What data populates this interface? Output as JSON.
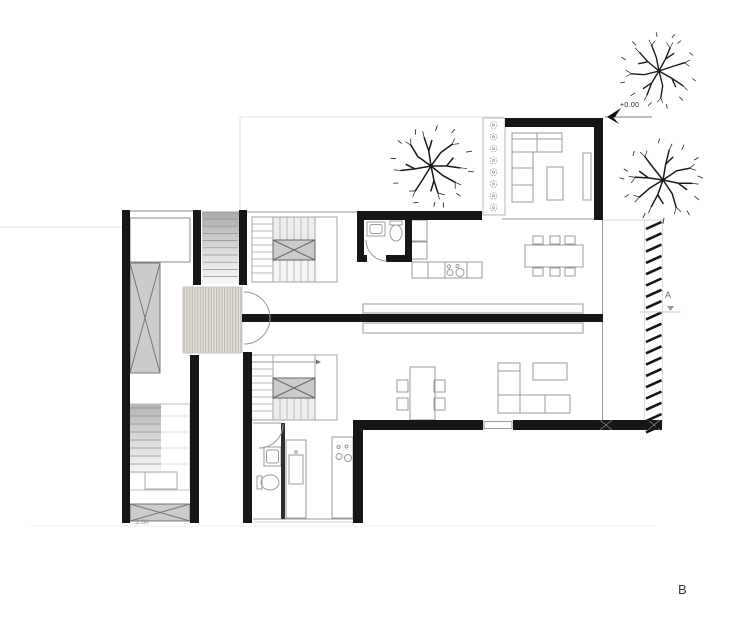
{
  "annotations": {
    "level_marker": "+0.00",
    "lower_stair_level": "2.00",
    "section_a": "A",
    "section_b": "B"
  },
  "colors": {
    "wall": "#161616",
    "thin_line": "#9b9b9b",
    "grey_fill": "#cbcbcb",
    "deck_fill": "#e2ded8",
    "deck_stripe": "#b7b2ac",
    "site_line": "#e3e3e3",
    "hatch": "#151515",
    "label": "#555555"
  },
  "counts": {
    "trees": 3,
    "planter_flowers": 8,
    "louver_hatch_marks": 19
  }
}
